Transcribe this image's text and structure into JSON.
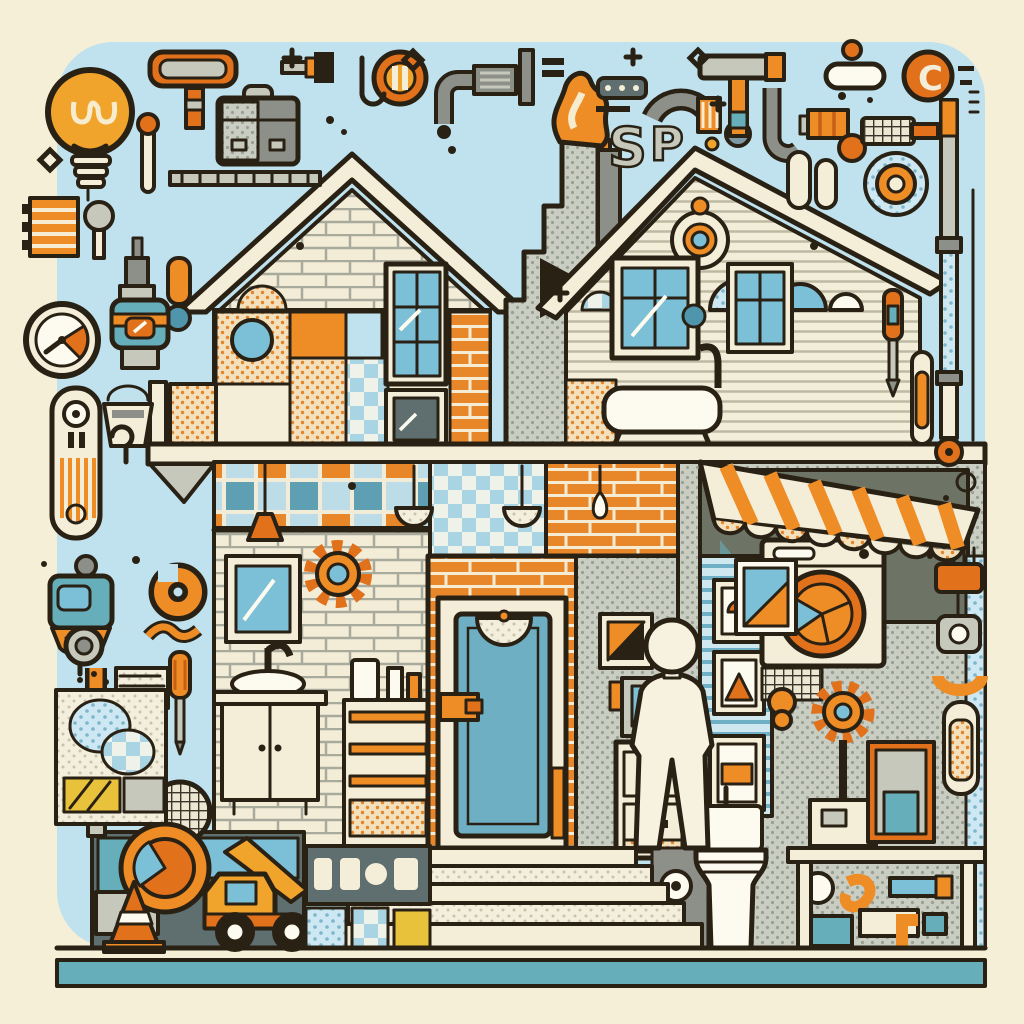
{
  "scene": {
    "title": "Home improvement patchwork house illustration",
    "description": "Flat line-art illustration: a cut-away patchwork house with bathroom, laundry and entry door, a person silhouette on the front steps, surrounded by scattered tools, pipes and fixtures on a light blue rounded canvas with a teal footer stripe",
    "objects": [
      "light bulb",
      "paint roller",
      "toolbox",
      "paint brush",
      "drying rack",
      "match",
      "ledger stack",
      "mallet",
      "pressure gauge",
      "power drill",
      "door handle plate",
      "paint bucket",
      "security camera",
      "elbow pipe",
      "pipe wrench",
      "screwdriver",
      "fabric panel",
      "mesh strainer",
      "concrete mixer truck",
      "traffic cone",
      "price sign",
      "chimney flame",
      "valve",
      "arc pipe",
      "pipe letters",
      "hammer",
      "j-pipe",
      "radiator",
      "hand roller",
      "pipe fitting",
      "control knob",
      "texture roller",
      "burner knob",
      "standpipe",
      "level capsule",
      "left house",
      "right house",
      "chimney",
      "windows",
      "bathtub",
      "faucet",
      "awning",
      "pendant lamps",
      "wall gear",
      "mirror",
      "bathroom vanity",
      "shelf unit",
      "front door",
      "person silhouette",
      "stairs",
      "toilet",
      "toilet paper",
      "washing machine",
      "framed pictures",
      "gear pedestal",
      "utility cabinet",
      "file cabinet",
      "monitor",
      "work table",
      "footer stripe"
    ]
  },
  "letters": {
    "pipe_s": "S",
    "pipe_p": "P",
    "knob_c": "C"
  },
  "palette": {
    "page-bg": "#f6efd8",
    "sky": "#bfe2ee",
    "ink": "#2a2115",
    "orange": "#ee8c26",
    "orange-deep": "#e2711c",
    "amber": "#f0a42c",
    "yellow": "#e8c23a",
    "cream": "#f4eed9",
    "white": "#fdfbf0",
    "gray": "#8d9089",
    "gray-light": "#c6c8bc",
    "slate": "#5f6e6e",
    "teal": "#66aeba",
    "blue": "#7cc0d8",
    "blue-deep": "#4f96ad",
    "door-blue": "#6fafc4",
    "olive": "#6d7466",
    "brick": "#e8862a"
  }
}
